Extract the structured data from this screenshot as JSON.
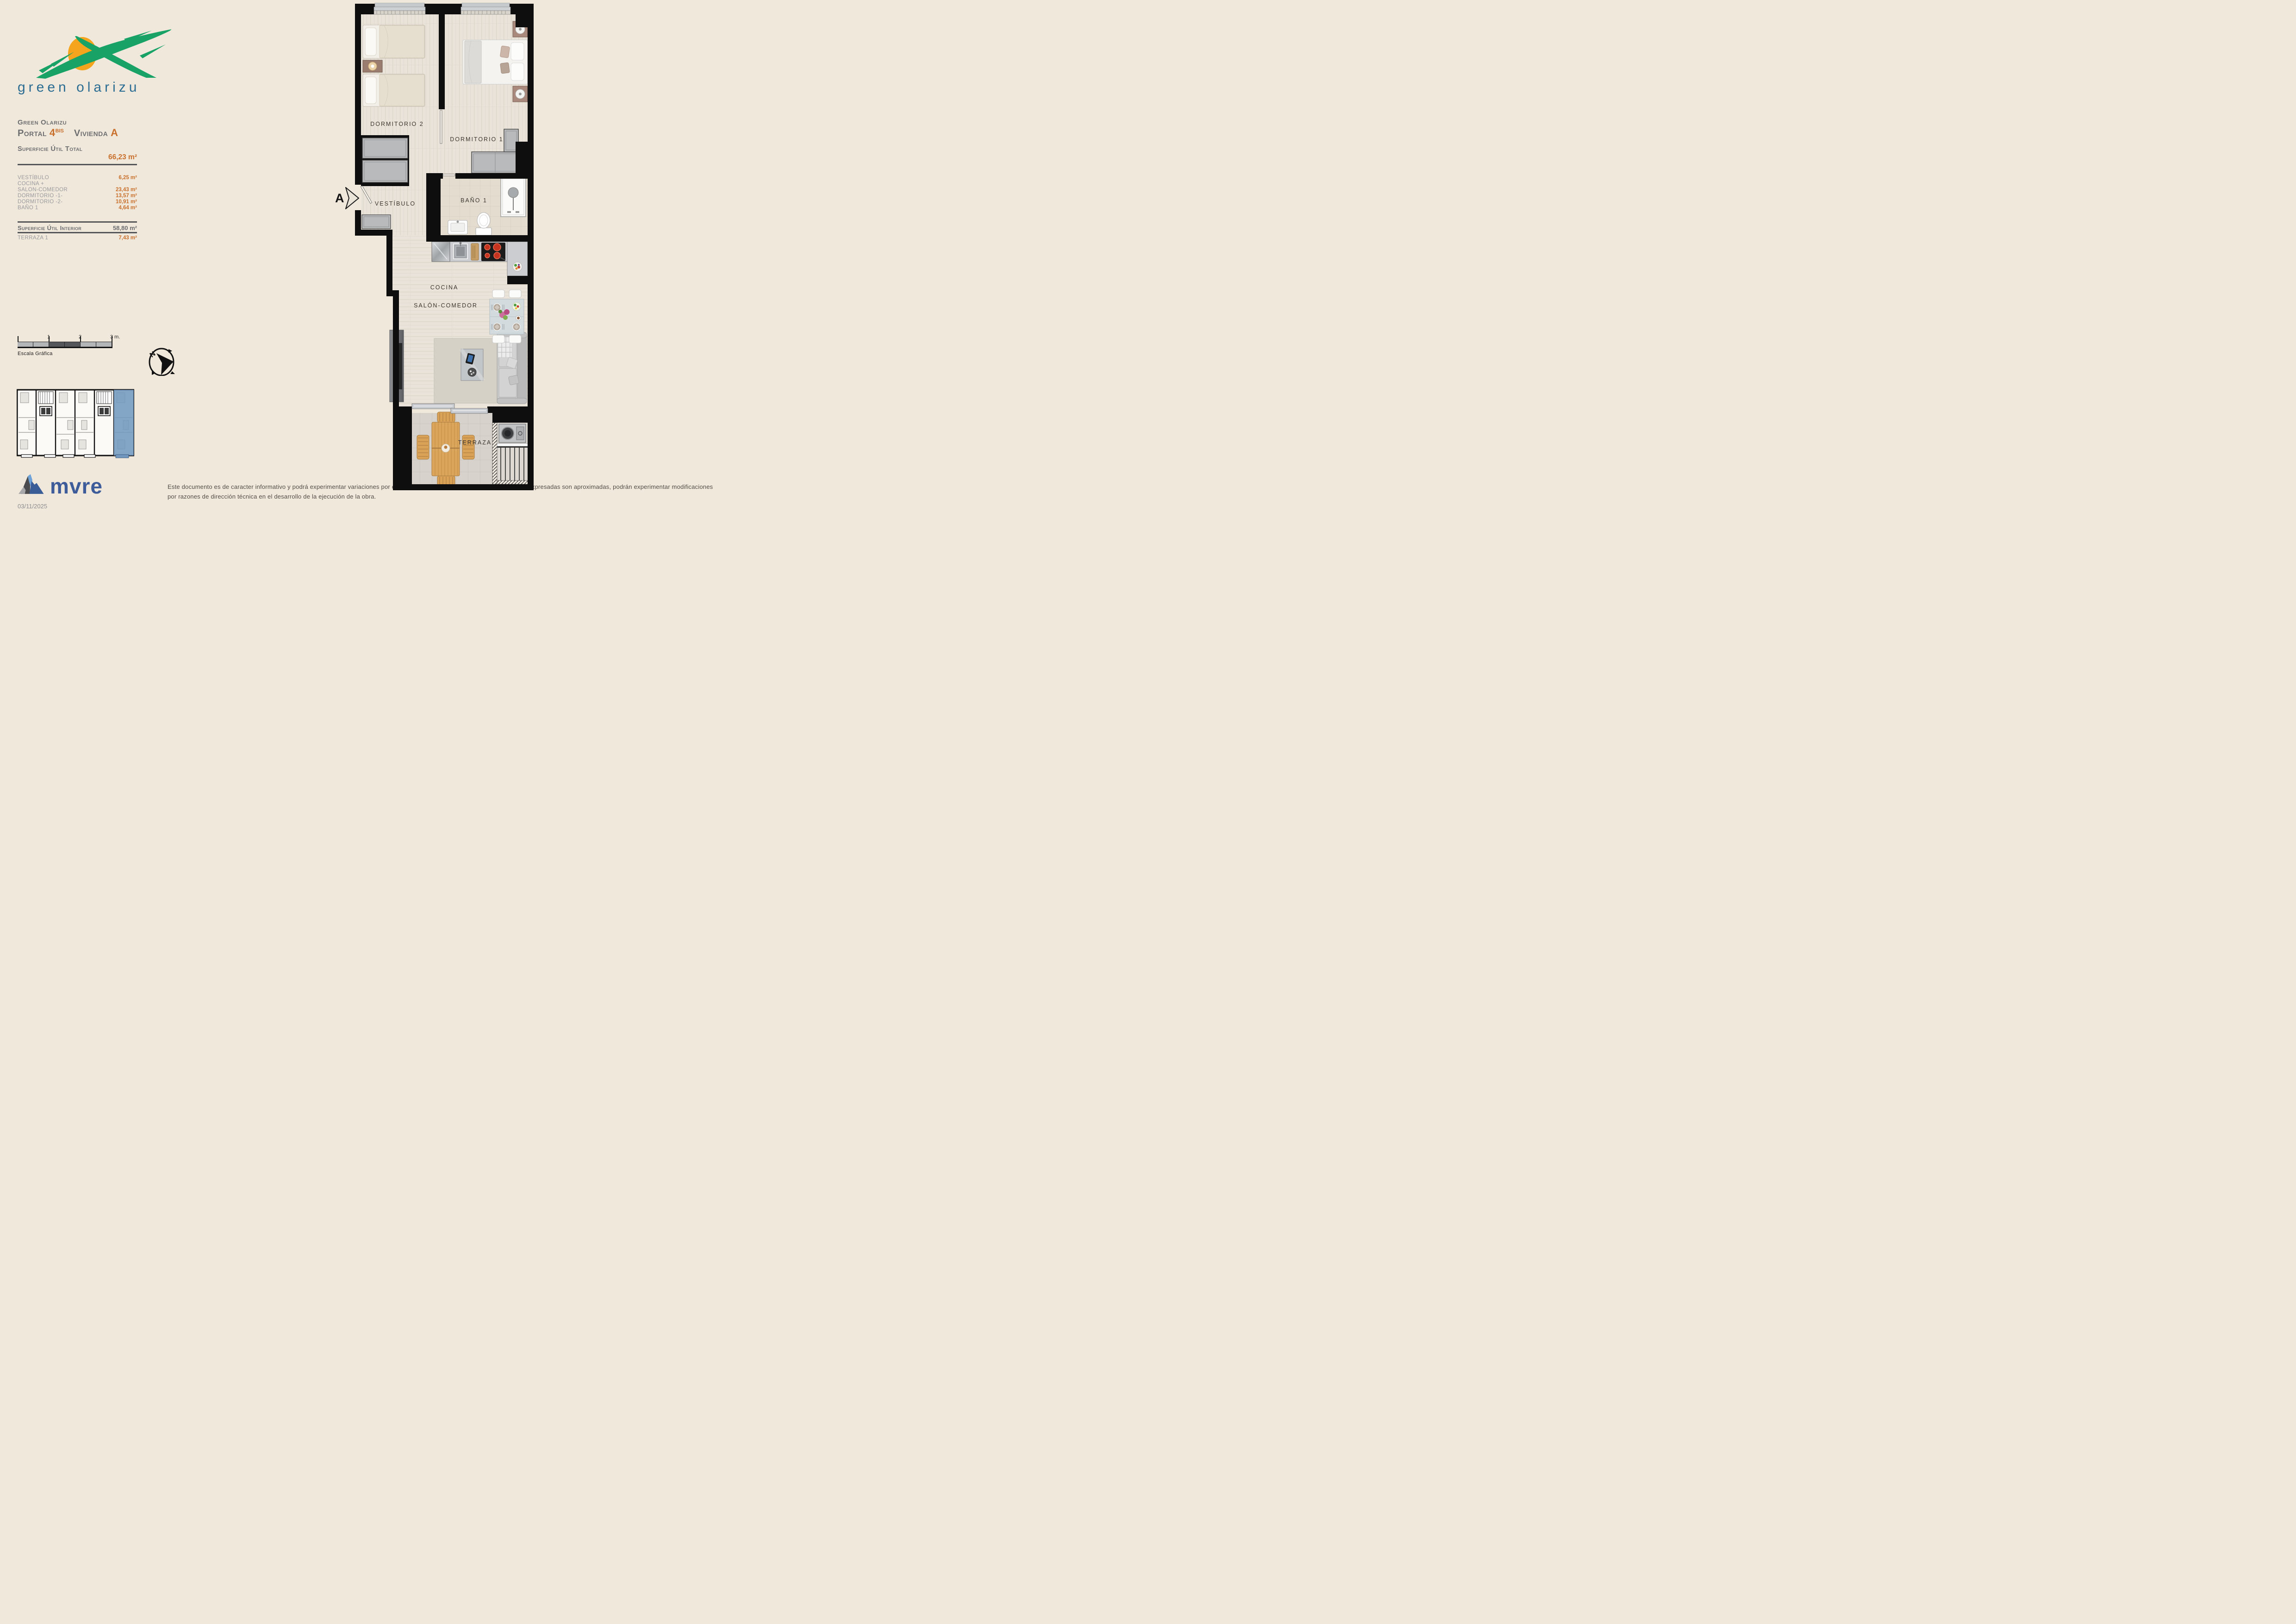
{
  "logo": {
    "wordmark": "green olarizu"
  },
  "header": {
    "project": "Green Olarizu",
    "portal_label": "Portal",
    "portal_number": "4",
    "portal_suffix": "BIS",
    "vivienda_label": "Vivienda",
    "vivienda_letter": "A",
    "total_label": "Superficie Útil Total",
    "total_value": "66,23 m²"
  },
  "surfaces": {
    "rows": [
      {
        "label": "VESTÍBULO",
        "value": "6,25 m²"
      },
      {
        "label": "COCINA +",
        "value": ""
      },
      {
        "label": "SALON-COMEDOR",
        "value": "23,43 m²"
      },
      {
        "label": "DORMITORIO -1-",
        "value": "13,57 m²"
      },
      {
        "label": "DORMITORIO -2-",
        "value": "10,91 m²"
      },
      {
        "label": "BAÑO 1",
        "value": "4,64 m²"
      }
    ],
    "interior_label": "Superficie Útil Interior",
    "interior_value": "58,80 m²",
    "terrace_label": "TERRAZA 1",
    "terrace_value": "7,43 m²"
  },
  "scalebar": {
    "caption": "Escala Gráfica",
    "tick1": "1",
    "tick2": "2",
    "tick3": "3 m."
  },
  "compass": {
    "north": "N"
  },
  "floorplan": {
    "marker": "A",
    "rooms": {
      "dormitorio2": "DORMITORIO 2",
      "dormitorio1": "DORMITORIO 1",
      "vestibulo": "VESTÍBULO",
      "bano1": "BAÑO 1",
      "cocina": "COCINA",
      "salon": "SALÓN-COMEDOR",
      "terraza": "TERRAZA"
    }
  },
  "footer": {
    "brand": "mvre",
    "date": "03/11/2025",
    "disclaimer": "Este documento es de caracter informativo y podrá experimentar variaciones por exigencias técnicas del proyecto. Las superficies expresadas son aproximadas, podrán experimentar modificaciones por razones de dirección técnica en el desarrollo de la ejecución de la obra."
  },
  "colors": {
    "background": "#f1e8dc",
    "accent_orange": "#c8702c",
    "title_gray": "#6d6e70",
    "row_gray": "#98999c",
    "logo_green": "#18a266",
    "logo_sun": "#f4a51d",
    "logo_blue": "#2b6d92",
    "mvre_blue": "#3d5c99",
    "keyplan_highlight": "#7298bf",
    "wall_black": "#0e0e0e"
  }
}
